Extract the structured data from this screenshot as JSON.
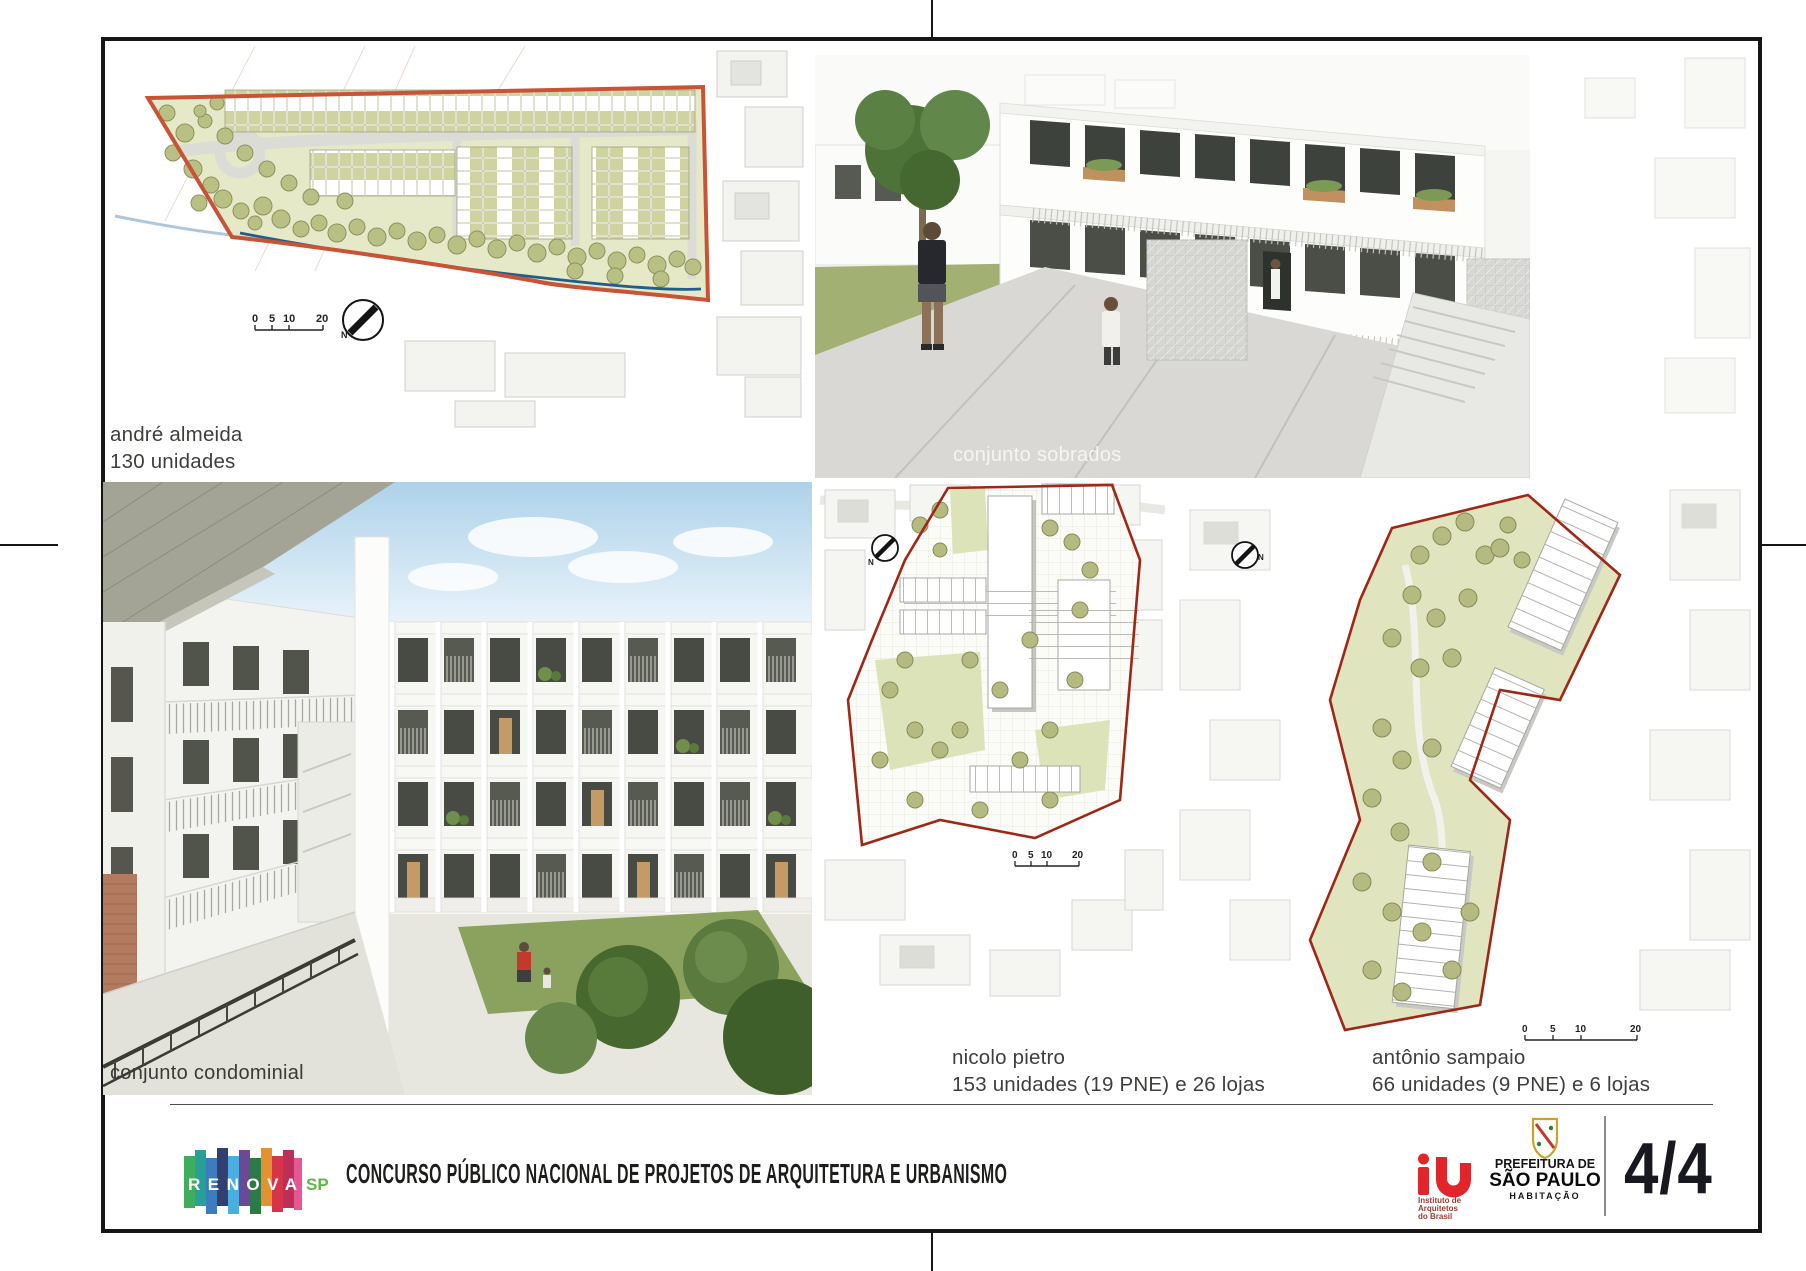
{
  "sheet": {
    "page_number": "4/4"
  },
  "footer": {
    "title": "CONCURSO PÚBLICO NACIONAL DE PROJETOS DE ARQUITETURA E URBANISMO",
    "renova": {
      "letters": "RENOVA",
      "sp": "SP"
    },
    "iab": {
      "line1": "Instituto de",
      "line2": "Arquitetos",
      "line3": "do Brasil"
    },
    "prefeitura": {
      "line1": "PREFEITURA DE",
      "line2": "SÃO PAULO",
      "line3": "HABITAÇÃO"
    }
  },
  "panels": {
    "andre_almeida": {
      "title": "andré almeida",
      "subtitle": "130 unidades",
      "north": "N",
      "scale": {
        "s0": "0",
        "s1": "5",
        "s2": "10",
        "s3": "20"
      }
    },
    "sobrados": {
      "caption": "conjunto sobrados"
    },
    "condominial": {
      "caption": "conjunto condominial"
    },
    "nicolo_pietro": {
      "title": "nicolo pietro",
      "subtitle": "153 unidades (19 PNE) e 26 lojas",
      "north": "N",
      "scale": {
        "s0": "0",
        "s1": "5",
        "s2": "10",
        "s3": "20"
      }
    },
    "antonio_sampaio": {
      "title": "antônio sampaio",
      "subtitle": "66 unidades (9 PNE) e 6 lojas",
      "north": "N",
      "scale": {
        "s0": "0",
        "s1": "5",
        "s2": "10",
        "s3": "20"
      }
    }
  },
  "colors": {
    "site_boundary_orange": "#c95336",
    "site_boundary_dark_red": "#9e2716",
    "site_green": "#e6e9c8",
    "tree_olive": "#b9c083",
    "creek_blue": "#205d8c",
    "iab_red": "#e1252b",
    "renova_sp_green": "#5cb947",
    "frame_black": "#161616"
  }
}
